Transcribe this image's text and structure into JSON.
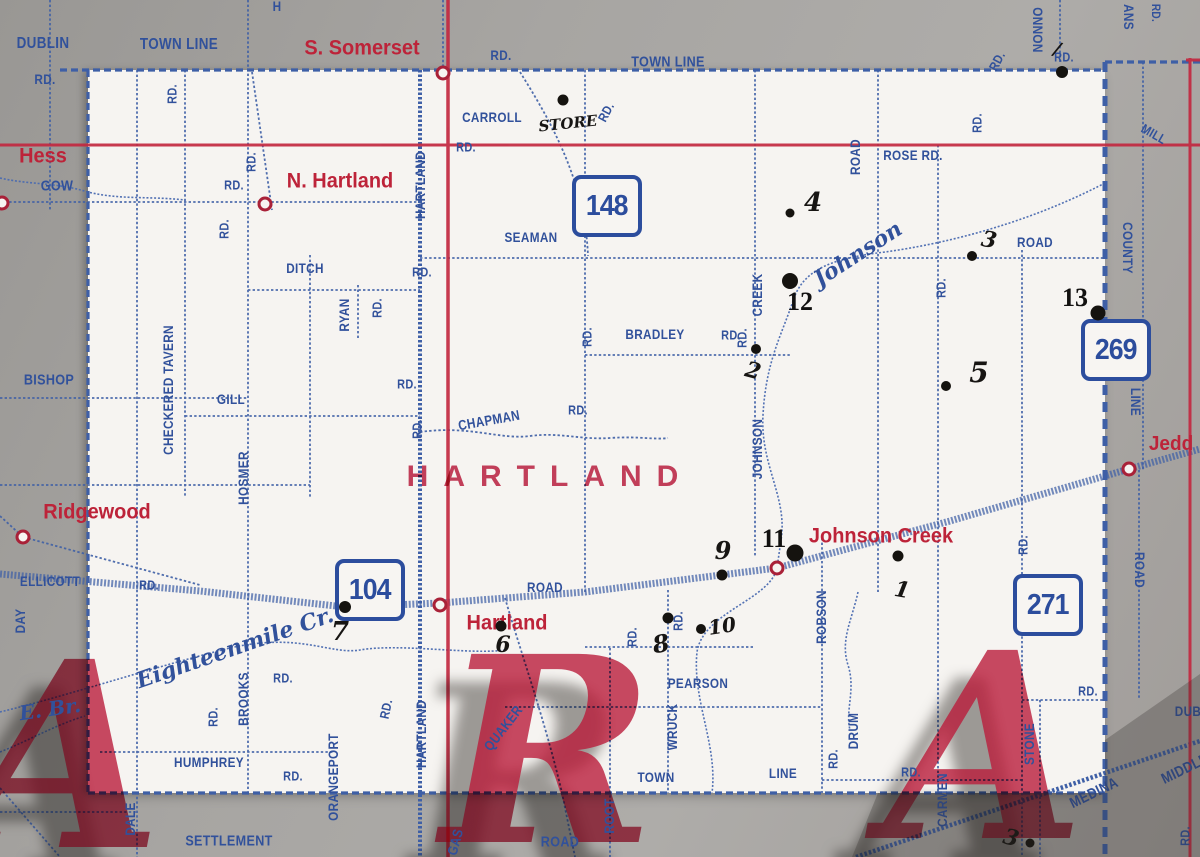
{
  "map": {
    "kind": "vintage county road map (paper, photographed)",
    "township_label": "HARTLAND",
    "overprint_letters": [
      {
        "t": "A",
        "x": 62,
        "y": 757
      },
      {
        "t": "R",
        "x": 548,
        "y": 752
      },
      {
        "t": "A",
        "x": 985,
        "y": 748
      }
    ],
    "colors": {
      "road_blue": "#31519b",
      "place_red": "#bd2339",
      "paper_white": "#f6f4f1",
      "margin_gray": "#a7a5a2",
      "pen_black": "#171513"
    }
  },
  "route_shields": [
    {
      "number": "148",
      "x": 607,
      "y": 206
    },
    {
      "number": "104",
      "x": 370,
      "y": 590
    },
    {
      "number": "269",
      "x": 1116,
      "y": 350
    },
    {
      "number": "271",
      "x": 1048,
      "y": 605
    }
  ],
  "place_labels": [
    {
      "t": "Hess",
      "x": 43,
      "y": 156,
      "s": 21
    },
    {
      "t": "S. Somerset",
      "x": 362,
      "y": 48,
      "s": 21
    },
    {
      "t": "N. Hartland",
      "x": 340,
      "y": 181,
      "s": 21
    },
    {
      "t": "Ridgewood",
      "x": 97,
      "y": 512,
      "s": 21
    },
    {
      "t": "Hartland",
      "x": 507,
      "y": 623,
      "s": 21
    },
    {
      "t": "Johnson Creek",
      "x": 881,
      "y": 536,
      "s": 21
    },
    {
      "t": "Jedd",
      "x": 1171,
      "y": 444,
      "s": 20
    }
  ],
  "village_circles": [
    {
      "n": "hess-gow",
      "x": 2,
      "y": 203
    },
    {
      "n": "s-somerset",
      "x": 443,
      "y": 73
    },
    {
      "n": "n-hartland",
      "x": 265,
      "y": 204
    },
    {
      "n": "ridgewood",
      "x": 23,
      "y": 537
    },
    {
      "n": "hartland",
      "x": 440,
      "y": 605
    },
    {
      "n": "johnson-creek",
      "x": 777,
      "y": 568
    },
    {
      "n": "jedd",
      "x": 1129,
      "y": 469
    }
  ],
  "road_labels": [
    {
      "t": "DUBLIN",
      "x": 43,
      "y": 44,
      "s": 16
    },
    {
      "t": "RD.",
      "x": 45,
      "y": 79,
      "s": 14
    },
    {
      "t": "TOWN LINE",
      "x": 179,
      "y": 45,
      "s": 16
    },
    {
      "t": "H",
      "x": 277,
      "y": 6,
      "s": 14
    },
    {
      "t": "RD.",
      "x": 501,
      "y": 55,
      "s": 14
    },
    {
      "t": "TOWN LINE",
      "x": 668,
      "y": 62,
      "s": 15
    },
    {
      "t": "RD.",
      "x": 997,
      "y": 61,
      "r": -62,
      "s": 13
    },
    {
      "t": "ONNON",
      "x": 1038,
      "y": 30,
      "r": 90,
      "s": 14
    },
    {
      "t": "RD.",
      "x": 1064,
      "y": 57,
      "s": 13
    },
    {
      "t": "ANS",
      "x": 1129,
      "y": 17,
      "r": 90,
      "s": 14
    },
    {
      "t": "RD.",
      "x": 1156,
      "y": 13,
      "r": 90,
      "s": 12
    },
    {
      "t": "MILL",
      "x": 1154,
      "y": 134,
      "r": 30,
      "s": 13
    },
    {
      "t": "GOW",
      "x": 57,
      "y": 186,
      "s": 15
    },
    {
      "t": "BISHOP",
      "x": 49,
      "y": 380,
      "s": 15
    },
    {
      "t": "ELLICOTT",
      "x": 50,
      "y": 581,
      "s": 14
    },
    {
      "t": "RD.",
      "x": 149,
      "y": 585,
      "s": 13
    },
    {
      "t": "DAY",
      "x": 20,
      "y": 621,
      "r": -90,
      "s": 14
    },
    {
      "t": "RD.",
      "x": 172,
      "y": 94,
      "r": -90,
      "s": 13
    },
    {
      "t": "RD.",
      "x": 251,
      "y": 162,
      "r": -90,
      "s": 13
    },
    {
      "t": "RD.",
      "x": 234,
      "y": 185,
      "s": 13
    },
    {
      "t": "RD.",
      "x": 224,
      "y": 229,
      "r": -90,
      "s": 13
    },
    {
      "t": "DITCH",
      "x": 305,
      "y": 268,
      "s": 14
    },
    {
      "t": "RD.",
      "x": 422,
      "y": 272,
      "s": 13
    },
    {
      "t": "RYAN",
      "x": 344,
      "y": 315,
      "r": -90,
      "s": 14
    },
    {
      "t": "RD.",
      "x": 377,
      "y": 308,
      "r": -90,
      "s": 13
    },
    {
      "t": "CHECKERED TAVERN",
      "x": 168,
      "y": 390,
      "r": -90,
      "s": 14
    },
    {
      "t": "HOSMER",
      "x": 243,
      "y": 478,
      "r": -90,
      "s": 14
    },
    {
      "t": "GILL",
      "x": 231,
      "y": 399,
      "s": 14
    },
    {
      "t": "RD.",
      "x": 407,
      "y": 384,
      "s": 13
    },
    {
      "t": "HARTLAND",
      "x": 420,
      "y": 185,
      "r": -90,
      "s": 14
    },
    {
      "t": "CARROLL",
      "x": 492,
      "y": 117,
      "s": 14
    },
    {
      "t": "RD.",
      "x": 466,
      "y": 147,
      "s": 13
    },
    {
      "t": "RD.",
      "x": 606,
      "y": 112,
      "r": -62,
      "s": 13
    },
    {
      "t": "SEAMAN",
      "x": 531,
      "y": 237,
      "s": 14
    },
    {
      "t": "CHAPMAN",
      "x": 489,
      "y": 420,
      "r": -10,
      "s": 14
    },
    {
      "t": "RD.",
      "x": 578,
      "y": 410,
      "s": 13
    },
    {
      "t": "RD.",
      "x": 417,
      "y": 429,
      "r": -90,
      "s": 13
    },
    {
      "t": "BRADLEY",
      "x": 655,
      "y": 334,
      "s": 14
    },
    {
      "t": "RD.",
      "x": 731,
      "y": 335,
      "s": 13
    },
    {
      "t": "RD.",
      "x": 587,
      "y": 337,
      "r": -90,
      "s": 13
    },
    {
      "t": "ROSE RD.",
      "x": 913,
      "y": 155,
      "s": 14
    },
    {
      "t": "ROAD",
      "x": 855,
      "y": 157,
      "r": -90,
      "s": 14
    },
    {
      "t": "RD.",
      "x": 977,
      "y": 123,
      "r": -90,
      "s": 13
    },
    {
      "t": "ROAD",
      "x": 1035,
      "y": 242,
      "s": 14
    },
    {
      "t": "RD.",
      "x": 941,
      "y": 288,
      "r": -90,
      "s": 13
    },
    {
      "t": "JOHNSON",
      "x": 757,
      "y": 449,
      "r": -90,
      "s": 14
    },
    {
      "t": "CREEK",
      "x": 757,
      "y": 295,
      "r": -90,
      "s": 14
    },
    {
      "t": "RD.",
      "x": 742,
      "y": 338,
      "r": -90,
      "s": 13
    },
    {
      "t": "COUNTY",
      "x": 1128,
      "y": 248,
      "r": 90,
      "s": 14
    },
    {
      "t": "LINE",
      "x": 1136,
      "y": 402,
      "r": 90,
      "s": 14
    },
    {
      "t": "ROAD",
      "x": 1140,
      "y": 570,
      "r": 90,
      "s": 14
    },
    {
      "t": "RD.",
      "x": 1023,
      "y": 545,
      "r": -90,
      "s": 13
    },
    {
      "t": "ROAD",
      "x": 545,
      "y": 587,
      "s": 14
    },
    {
      "t": "ROBSON",
      "x": 821,
      "y": 617,
      "r": -90,
      "s": 14
    },
    {
      "t": "PEARSON",
      "x": 698,
      "y": 683,
      "s": 14
    },
    {
      "t": "RD.",
      "x": 632,
      "y": 637,
      "r": -90,
      "s": 13
    },
    {
      "t": "RD.",
      "x": 678,
      "y": 621,
      "r": -90,
      "s": 13
    },
    {
      "t": "WRUCK",
      "x": 672,
      "y": 727,
      "r": -90,
      "s": 14
    },
    {
      "t": "TOWN",
      "x": 656,
      "y": 777,
      "s": 14
    },
    {
      "t": "LINE",
      "x": 783,
      "y": 773,
      "s": 14
    },
    {
      "t": "DRUM",
      "x": 853,
      "y": 731,
      "r": -90,
      "s": 14
    },
    {
      "t": "RD.",
      "x": 833,
      "y": 759,
      "r": -90,
      "s": 13
    },
    {
      "t": "RD.",
      "x": 911,
      "y": 772,
      "s": 13
    },
    {
      "t": "RD.",
      "x": 1088,
      "y": 691,
      "s": 13
    },
    {
      "t": "QUAKER",
      "x": 503,
      "y": 728,
      "r": -52,
      "s": 14
    },
    {
      "t": "HARTLAND",
      "x": 421,
      "y": 734,
      "r": -90,
      "s": 14
    },
    {
      "t": "ORANGEPORT",
      "x": 333,
      "y": 777,
      "r": -90,
      "s": 14
    },
    {
      "t": "BROOKS",
      "x": 243,
      "y": 699,
      "r": -90,
      "s": 14
    },
    {
      "t": "RD.",
      "x": 213,
      "y": 717,
      "r": -90,
      "s": 13
    },
    {
      "t": "RD.",
      "x": 283,
      "y": 678,
      "s": 13
    },
    {
      "t": "HUMPHREY",
      "x": 209,
      "y": 762,
      "s": 14
    },
    {
      "t": "RD.",
      "x": 293,
      "y": 776,
      "s": 13
    },
    {
      "t": "RD.",
      "x": 386,
      "y": 709,
      "r": -78,
      "s": 13
    },
    {
      "t": "DALE",
      "x": 130,
      "y": 819,
      "r": -90,
      "s": 14
    },
    {
      "t": "SETTLEMENT",
      "x": 229,
      "y": 841,
      "s": 15
    },
    {
      "t": "GAS",
      "x": 455,
      "y": 842,
      "r": -75,
      "s": 14
    },
    {
      "t": "ROAD",
      "x": 560,
      "y": 842,
      "s": 15
    },
    {
      "t": "ROOT",
      "x": 609,
      "y": 816,
      "r": -90,
      "s": 14
    },
    {
      "t": "CARMEN",
      "x": 942,
      "y": 800,
      "r": -90,
      "s": 14
    },
    {
      "t": "STONE",
      "x": 1029,
      "y": 744,
      "r": -90,
      "s": 14
    },
    {
      "t": "MEDINA",
      "x": 1094,
      "y": 793,
      "r": -26,
      "s": 15
    },
    {
      "t": "MIDDLE",
      "x": 1185,
      "y": 769,
      "r": -26,
      "s": 15
    },
    {
      "t": "DUB",
      "x": 1188,
      "y": 711,
      "s": 14
    },
    {
      "t": "RD.",
      "x": 1185,
      "y": 836,
      "r": -90,
      "s": 13
    },
    {
      "t": "Johnson",
      "x": 858,
      "y": 254,
      "r": -33,
      "s": 22,
      "f": "script"
    },
    {
      "t": "Eighteenmile Cr.",
      "x": 235,
      "y": 648,
      "r": -19,
      "s": 22,
      "f": "script"
    },
    {
      "t": "E. Br.",
      "x": 50,
      "y": 709,
      "r": -8,
      "s": 20,
      "f": "script"
    }
  ],
  "handwritten_marks": [
    {
      "t": "STORE",
      "x": 568,
      "y": 124,
      "r": -6,
      "s": 15
    },
    {
      "t": "/",
      "x": 1057,
      "y": 50,
      "r": 12,
      "s": 18
    },
    {
      "t": "4",
      "x": 813,
      "y": 203,
      "s": 26
    },
    {
      "t": "3",
      "x": 989,
      "y": 240,
      "r": 10,
      "s": 22
    },
    {
      "t": "5",
      "x": 979,
      "y": 373,
      "s": 28
    },
    {
      "t": "2",
      "x": 753,
      "y": 371,
      "r": 15,
      "s": 22
    },
    {
      "t": "1",
      "x": 902,
      "y": 590,
      "r": 10,
      "s": 22
    },
    {
      "t": "7",
      "x": 340,
      "y": 632,
      "s": 26
    },
    {
      "t": "6",
      "x": 503,
      "y": 645,
      "s": 22
    },
    {
      "t": "8",
      "x": 661,
      "y": 644,
      "r": -10,
      "s": 24
    },
    {
      "t": "10",
      "x": 722,
      "y": 626,
      "r": -8,
      "s": 20
    },
    {
      "t": "9",
      "x": 723,
      "y": 551,
      "s": 24
    },
    {
      "t": "3",
      "x": 1011,
      "y": 838,
      "r": 15,
      "s": 22
    }
  ],
  "typed_marks": [
    {
      "t": "11",
      "x": 774,
      "y": 539
    },
    {
      "t": "12",
      "x": 800,
      "y": 302
    },
    {
      "t": "13",
      "x": 1075,
      "y": 298
    }
  ],
  "poi_dots": [
    {
      "x": 563,
      "y": 100,
      "d": 11
    },
    {
      "x": 1062,
      "y": 72,
      "d": 12
    },
    {
      "x": 790,
      "y": 281,
      "d": 16
    },
    {
      "x": 972,
      "y": 256,
      "d": 10
    },
    {
      "x": 790,
      "y": 213,
      "d": 9
    },
    {
      "x": 756,
      "y": 349,
      "d": 10
    },
    {
      "x": 946,
      "y": 386,
      "d": 10
    },
    {
      "x": 1098,
      "y": 313,
      "d": 15
    },
    {
      "x": 795,
      "y": 553,
      "d": 17
    },
    {
      "x": 722,
      "y": 575,
      "d": 11
    },
    {
      "x": 898,
      "y": 556,
      "d": 11
    },
    {
      "x": 345,
      "y": 607,
      "d": 12
    },
    {
      "x": 501,
      "y": 626,
      "d": 11
    },
    {
      "x": 668,
      "y": 618,
      "d": 11
    },
    {
      "x": 701,
      "y": 629,
      "d": 10
    },
    {
      "x": 1030,
      "y": 843,
      "d": 9
    }
  ]
}
